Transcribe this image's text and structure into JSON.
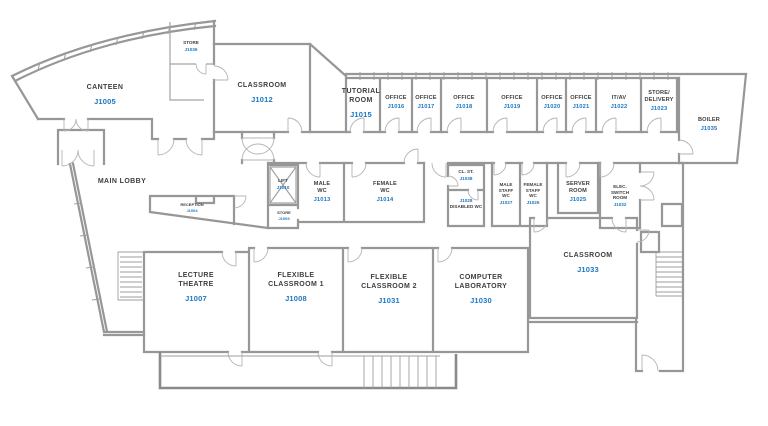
{
  "colors": {
    "room_name": "#3e3e3e",
    "room_id": "#1b77c3",
    "wall": "#9a9a9a"
  },
  "rooms": {
    "canteen": {
      "name": "CANTEEN",
      "id": "J1005"
    },
    "store_top": {
      "name": "STORE",
      "id": "J1036"
    },
    "classroom_j1012": {
      "name": "CLASSROOM",
      "id": "J1012"
    },
    "tutorial": {
      "name": "TUTORIAL ROOM",
      "id": "J1015"
    },
    "office_j1016": {
      "name": "OFFICE",
      "id": "J1016"
    },
    "office_j1017": {
      "name": "OFFICE",
      "id": "J1017"
    },
    "office_j1018": {
      "name": "OFFICE",
      "id": "J1018"
    },
    "office_j1019": {
      "name": "OFFICE",
      "id": "J1019"
    },
    "office_j1020": {
      "name": "OFFICE",
      "id": "J1020"
    },
    "office_j1021": {
      "name": "OFFICE",
      "id": "J1021"
    },
    "itav": {
      "name": "IT/AV",
      "id": "J1022"
    },
    "store_delivery": {
      "name": "STORE/ DELIVERY",
      "id": "J1023"
    },
    "boiler": {
      "name": "BOILER",
      "id": "J1035"
    },
    "main_lobby": {
      "name": "MAIN LOBBY",
      "id": ""
    },
    "reception": {
      "name": "RECEPTION",
      "id": "J1004"
    },
    "lift": {
      "name": "LIFT",
      "id": "J1010"
    },
    "store_j1009": {
      "name": "STORE",
      "id": "J1009"
    },
    "male_wc": {
      "name": "MALE WC",
      "id": "J1013"
    },
    "female_wc": {
      "name": "FEMALE WC",
      "id": "J1014"
    },
    "cl_st": {
      "name": "CL. ST.",
      "id": "J1038"
    },
    "disabled_wc": {
      "name": "DISABLED WC",
      "id": "J1028"
    },
    "male_staff_wc": {
      "name": "MALE STAFF WC",
      "id": "J1027"
    },
    "female_staff_wc": {
      "name": "FEMALE STAFF WC",
      "id": "J1026"
    },
    "server_room": {
      "name": "SERVER ROOM",
      "id": "J1025"
    },
    "elec_switch": {
      "name": "ELEC. SWITCH ROOM",
      "id": "J1032"
    },
    "lecture_theatre": {
      "name": "LECTURE THEATRE",
      "id": "J1007"
    },
    "flex1": {
      "name": "FLEXIBLE CLASSROOM 1",
      "id": "J1008"
    },
    "flex2": {
      "name": "FLEXIBLE CLASSROOM 2",
      "id": "J1031"
    },
    "computer_lab": {
      "name": "COMPUTER LABORATORY",
      "id": "J1030"
    },
    "classroom_j1033": {
      "name": "CLASSROOM",
      "id": "J1033"
    }
  }
}
